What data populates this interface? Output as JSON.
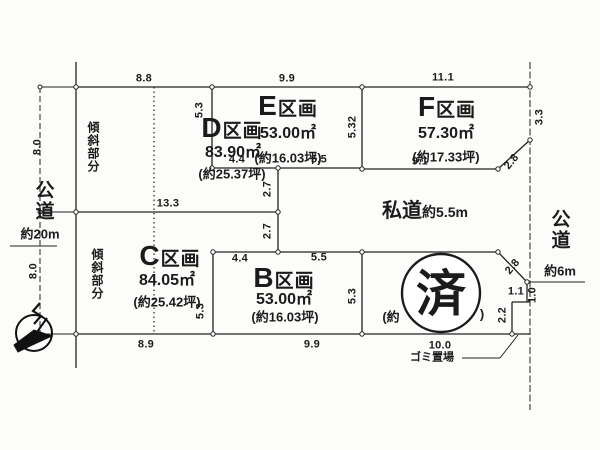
{
  "plots": [
    {
      "letter": "D",
      "suffix": "区画",
      "sqm": "83.90㎡",
      "tsubo": "(約25.37坪)"
    },
    {
      "letter": "E",
      "suffix": "区画",
      "sqm": "53.00㎡",
      "tsubo": "(約16.03坪)"
    },
    {
      "letter": "F",
      "suffix": "区画",
      "sqm": "57.30㎡",
      "tsubo": "(約17.33坪)"
    },
    {
      "letter": "C",
      "suffix": "区画",
      "sqm": "84.05㎡",
      "tsubo": "(約25.42坪)"
    },
    {
      "letter": "B",
      "suffix": "区画",
      "sqm": "53.00㎡",
      "tsubo": "(約16.03坪)"
    }
  ],
  "sold_plot": {
    "stamp": "済",
    "frag_left": "(約",
    "frag_right": ")"
  },
  "roads": {
    "west_name": "公道",
    "west_width": "約20m",
    "east_name": "公道",
    "east_width": "約6m",
    "private_name": "私道",
    "private_width": "約5.5m"
  },
  "slope_upper": "傾斜部分",
  "slope_lower": "傾斜部分",
  "garbage": "ゴミ置場",
  "dims": {
    "top_d": "8.8",
    "top_e": "9.9",
    "top_f": "11.1",
    "west_upper": "8.0",
    "west_lower": "8.0",
    "e_left": "5.3",
    "e_right": "5.32",
    "e_bot_l": "4.4",
    "e_bot_r": "5.5",
    "f_right": "3.3",
    "f_corner": "2.8",
    "f_bottom": "9.1",
    "d_bottom": "13.3",
    "road_upper": "2.7",
    "road_lower": "2.7",
    "b_top_l": "4.4",
    "b_top_r": "5.5",
    "b_left": "5.3",
    "a_left": "5.3",
    "se_corner": "2.8",
    "a_east": "1.0",
    "notch_w": "1.1",
    "notch_h": "2.2",
    "bot_c": "8.9",
    "bot_b": "9.9",
    "bot_a": "10.0"
  }
}
